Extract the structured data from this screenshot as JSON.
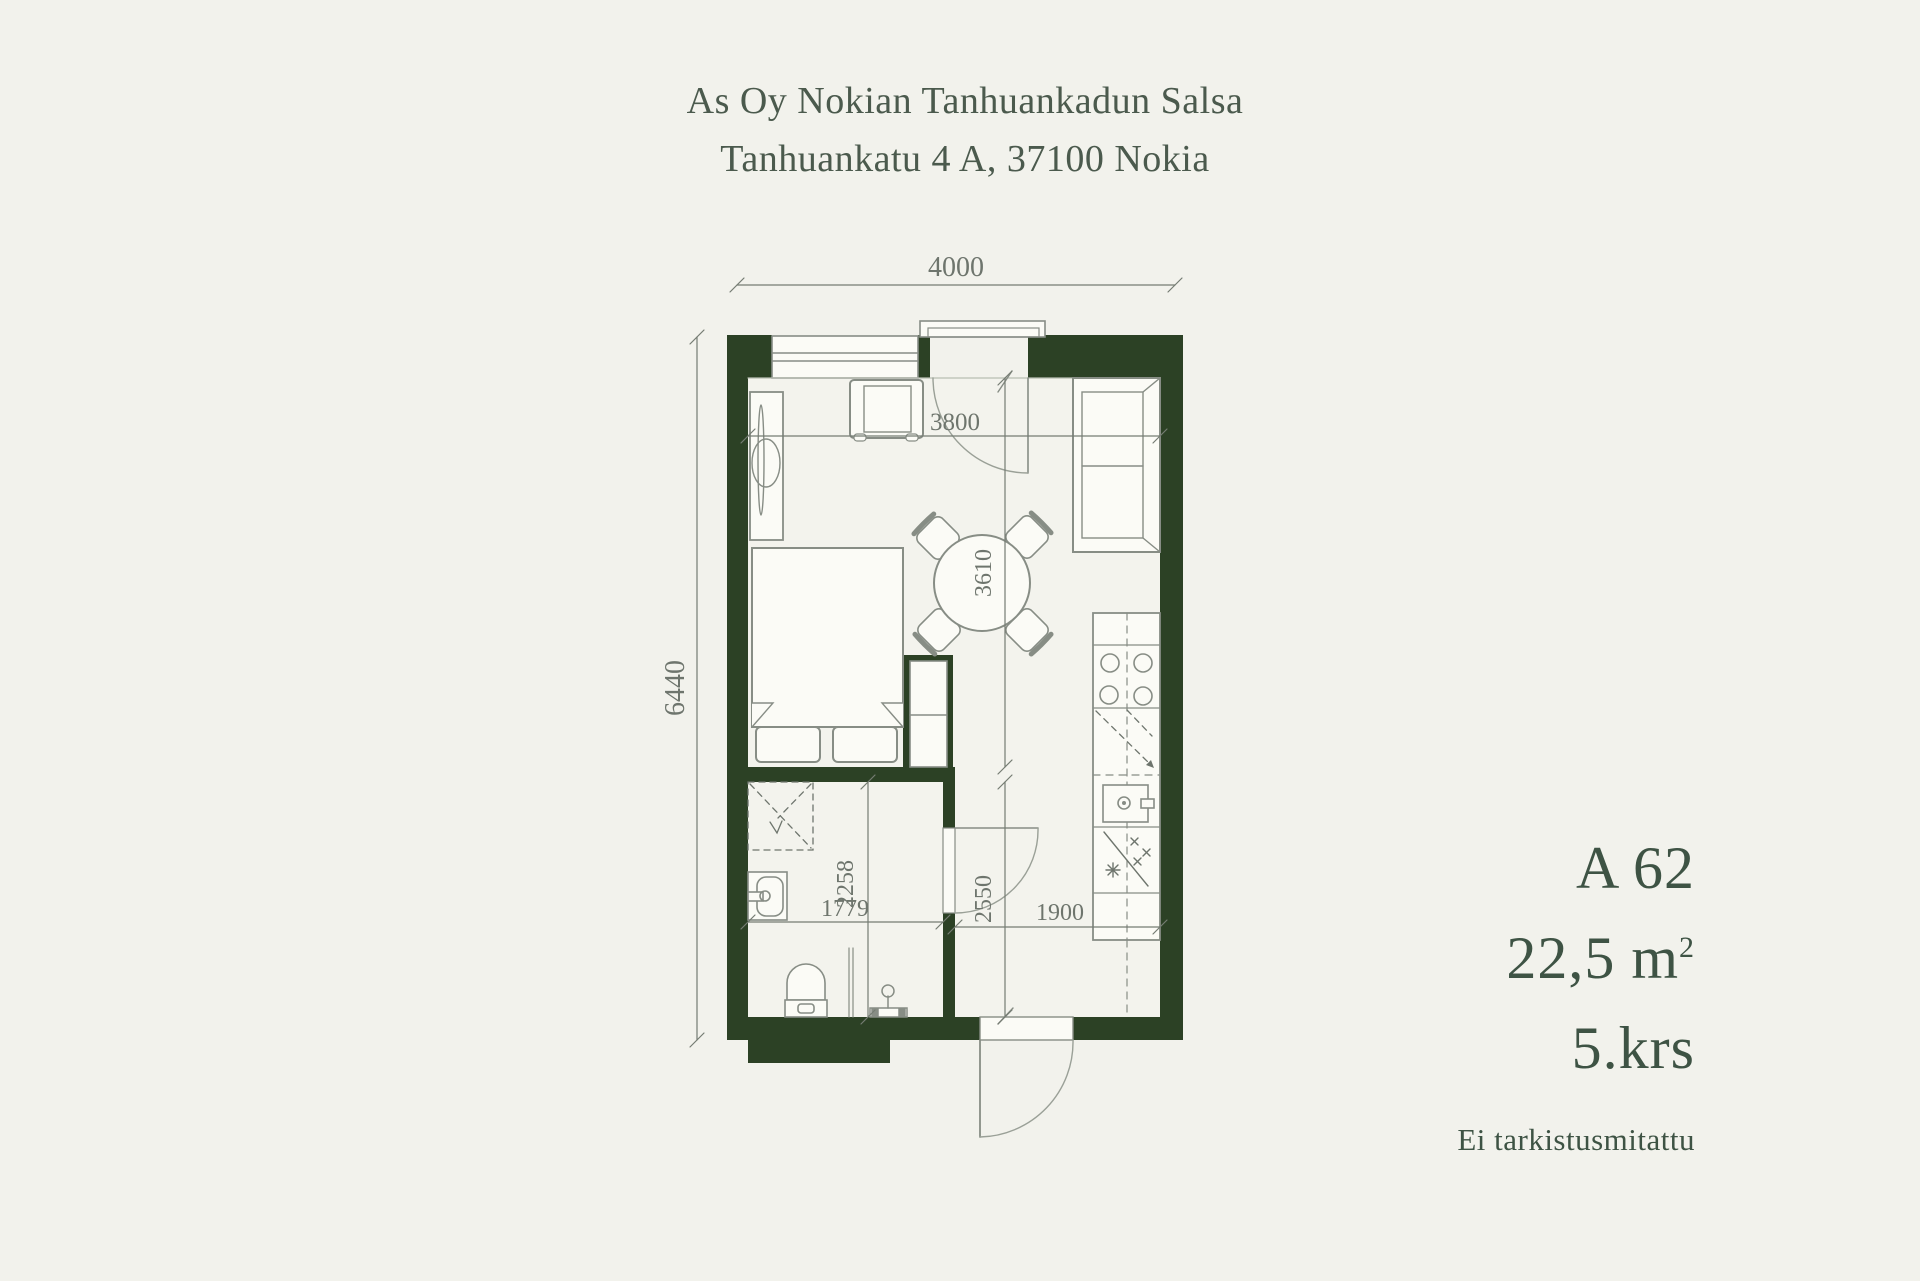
{
  "header": {
    "title_line1": "As Oy Nokian Tanhuankadun Salsa",
    "title_line2": "Tanhuankatu 4 A, 37100 Nokia"
  },
  "apartment_info": {
    "unit": "A 62",
    "area_value": "22,5 m",
    "area_superscript": "2",
    "floor": "5.krs",
    "note": "Ei tarkistusmitattu"
  },
  "floor_plan": {
    "dimensions": {
      "total_width_mm": "4000",
      "total_height_mm": "6440",
      "living_width_mm": "3800",
      "living_height_mm": "3610",
      "bath_width_mm": "1779",
      "bath_height_mm": "2258",
      "hall_height_mm": "2550",
      "kitchen_width_mm": "1900"
    }
  },
  "colors": {
    "background": "#f2f2ec",
    "wall": "#2c4125",
    "furniture_line": "#878d85",
    "dimension": "#6e756d",
    "text": "#3e5344"
  }
}
